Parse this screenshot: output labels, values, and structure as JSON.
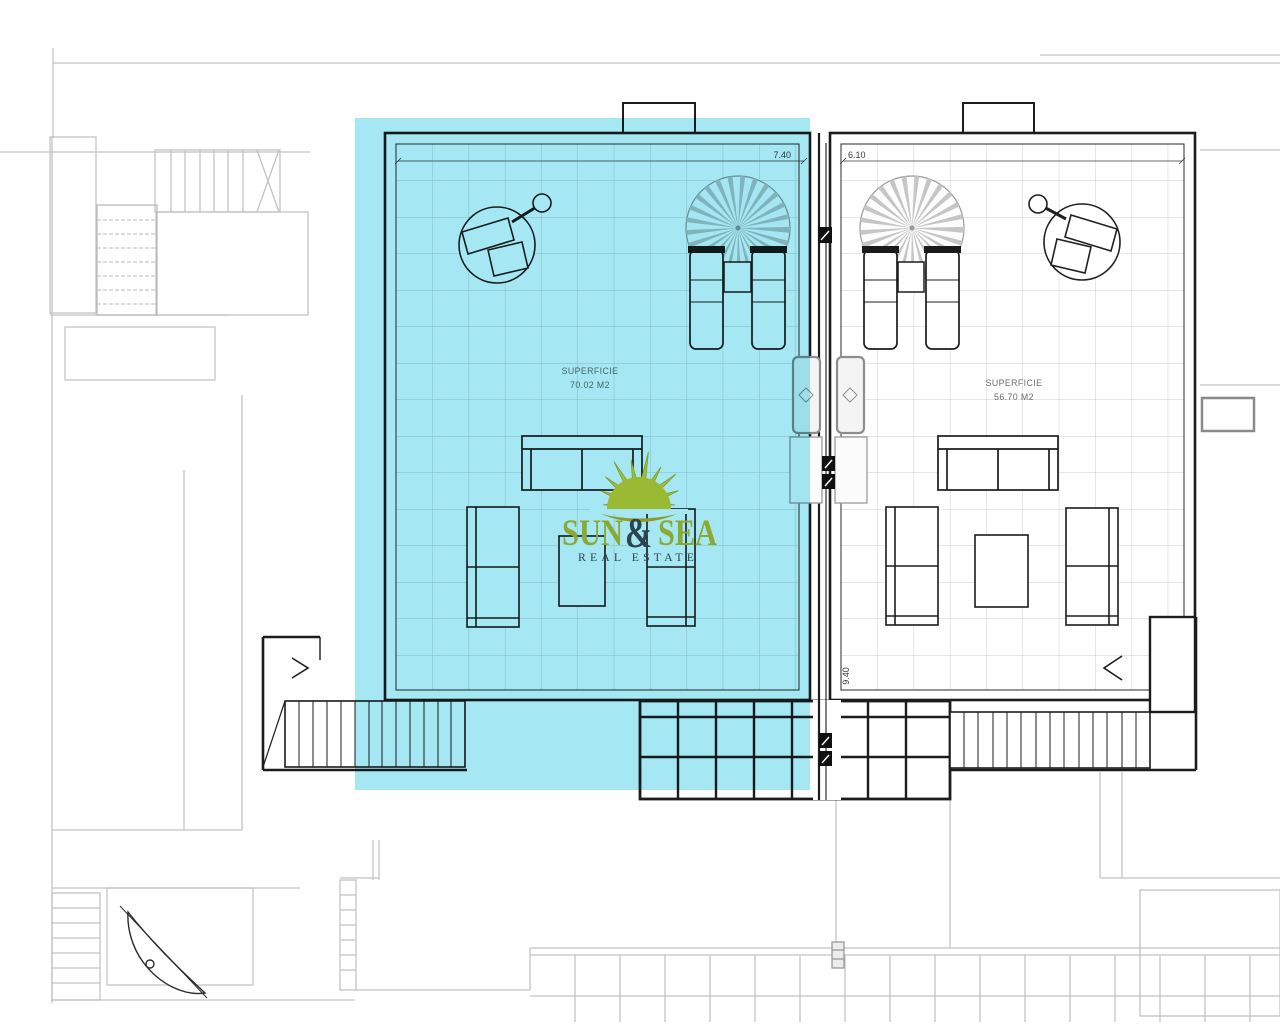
{
  "title": "Penthouse roof terrace floor plan",
  "watermark": {
    "word1": "SUN",
    "amp": "&",
    "word2": "SEA",
    "subtitle": "REAL ESTATE"
  },
  "terraces": {
    "left": {
      "area_label": "SUPERFICIE",
      "area_value": "70.02 M2",
      "width": "7.40",
      "highlighted": true
    },
    "right": {
      "area_label": "SUPERFICIE",
      "area_value": "56.70 M2",
      "width": "6.10",
      "depth": "9.40"
    }
  },
  "colors": {
    "highlight": "#6edaec",
    "logo_gold": "#d8bb35",
    "logo_slate": "#454c55",
    "line_dark": "#1c1c1c",
    "line_gray": "#c2c2c2"
  }
}
